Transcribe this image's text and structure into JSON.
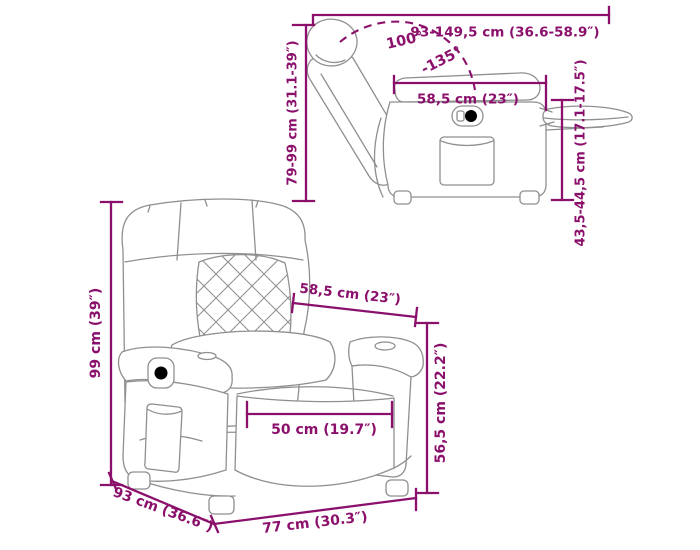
{
  "colors": {
    "dimension": "#8b106c",
    "chair_outline": "#8f8f8f",
    "background": "#ffffff"
  },
  "side_view": {
    "labels": {
      "extended_length": "93-149,5 cm (36.6-58.9″)",
      "height": "79-99 cm (31.1-39″)",
      "seat_depth": "58,5 cm (23″)",
      "recline_angle_min": "100°",
      "recline_angle_max": "-135°",
      "footrest_height": "43,5-44,5 cm (17.1-17.5″)"
    }
  },
  "front_view": {
    "labels": {
      "height": "99 cm (39″)",
      "depth": "93 cm (36.6″)",
      "width": "77 cm (30.3″)",
      "seat_width": "58,5 cm (23″)",
      "seat_front_width": "50 cm (19.7″)",
      "seat_height": "56,5 cm (22.2″)"
    }
  }
}
